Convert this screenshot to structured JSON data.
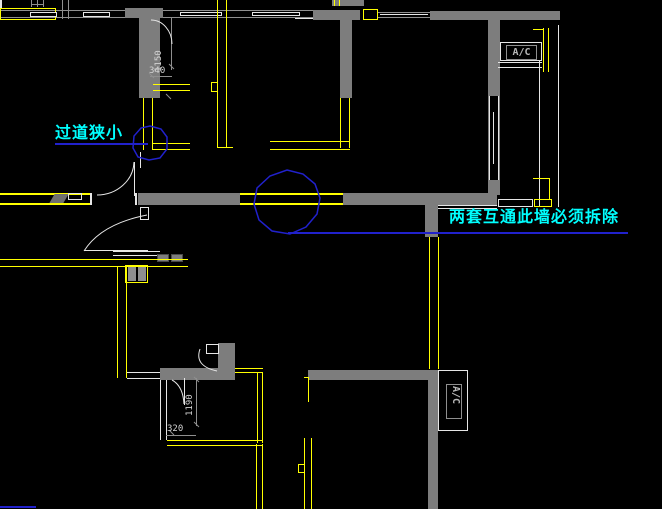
{
  "drawing": {
    "annotations": {
      "narrow_passage": "过道狭小",
      "demolish_wall": "两套互通此墙必须拆除"
    },
    "dimensions": {
      "hall_width": "1150",
      "hall_offset": "340",
      "room_width": "1190",
      "room_offset": "320"
    },
    "labels": {
      "ac_top": "A/C",
      "ac_bottom": "A/C"
    },
    "palette": {
      "background": "#000000",
      "wall": "#7d7d7d",
      "yellow": "#ffff00",
      "cyan": "#00ffff",
      "blue": "#2121cc",
      "white_line": "#e6e6e6",
      "gray_line": "#8f8f8f",
      "dim_text": "#d4d4d4"
    }
  }
}
